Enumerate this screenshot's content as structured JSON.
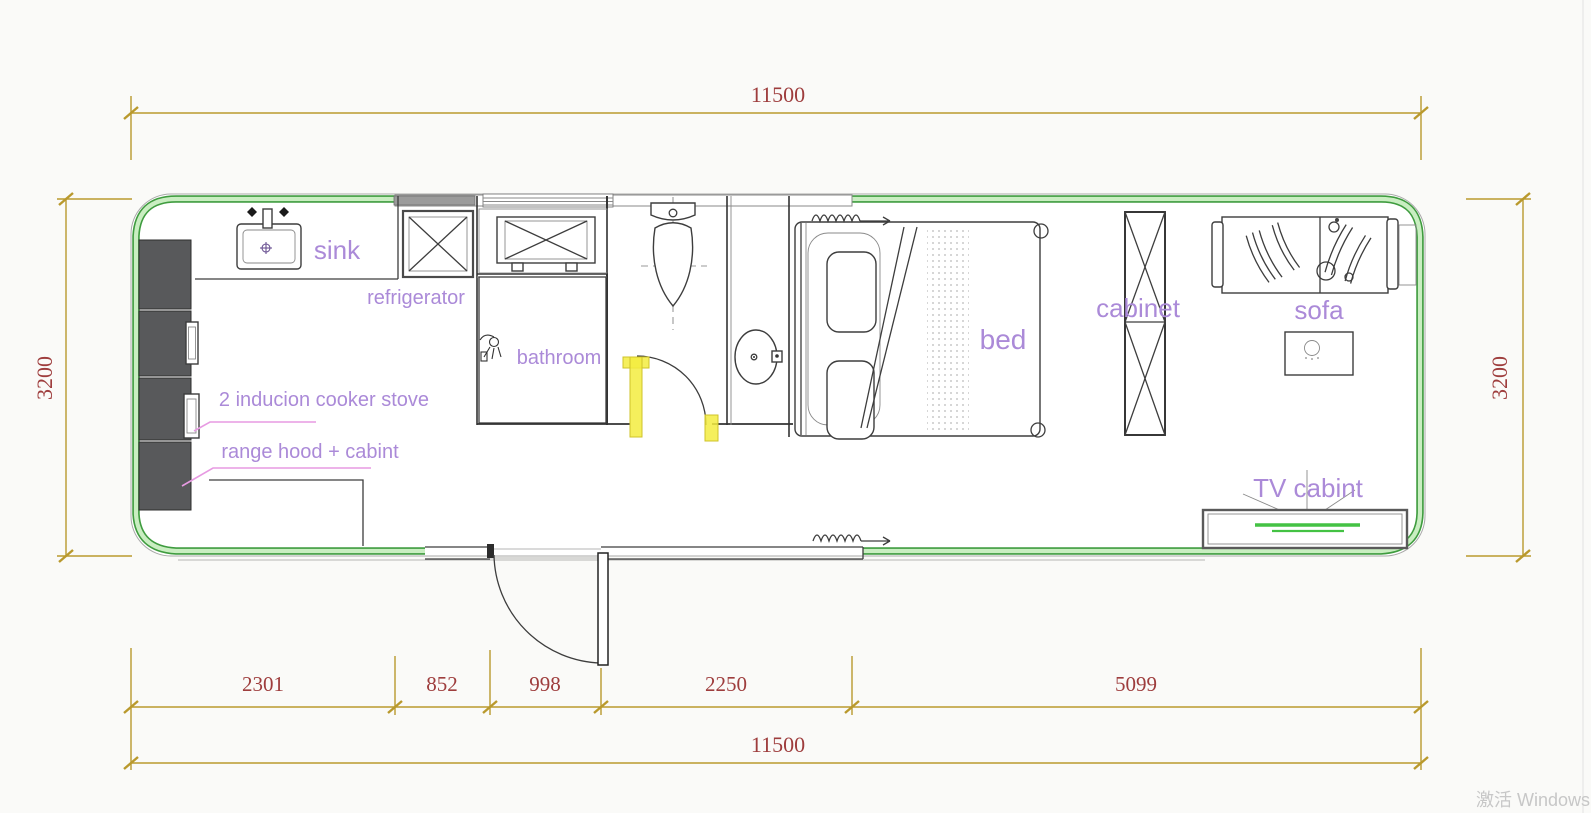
{
  "dimensions": {
    "top_total": "11500",
    "bottom_total": "11500",
    "left_height": "3200",
    "right_height": "3200",
    "bottom_segments": [
      "2301",
      "852",
      "998",
      "2250",
      "5099"
    ]
  },
  "labels": {
    "sink": "sink",
    "refrigerator": "refrigerator",
    "bathroom": "bathroom",
    "induction_cooker": "2 inducion cooker stove",
    "range_hood": "range hood + cabint",
    "bed": "bed",
    "cabinet": "cabinet",
    "sofa": "sofa",
    "tv_cabinet": "TV cabint"
  },
  "watermark": "激活 Windows",
  "colors": {
    "wall_green_dark": "#3f9c3f",
    "wall_green_light": "#c9eec1",
    "dim_gold": "#b9992d",
    "dim_red": "#9e3d3d",
    "label_purple": "#ab8ad8",
    "leader_pink": "#e79ae2",
    "door_yellow": "#f3ec3f",
    "tv_green": "#44c244",
    "cabinet_dark": "#58595b"
  }
}
